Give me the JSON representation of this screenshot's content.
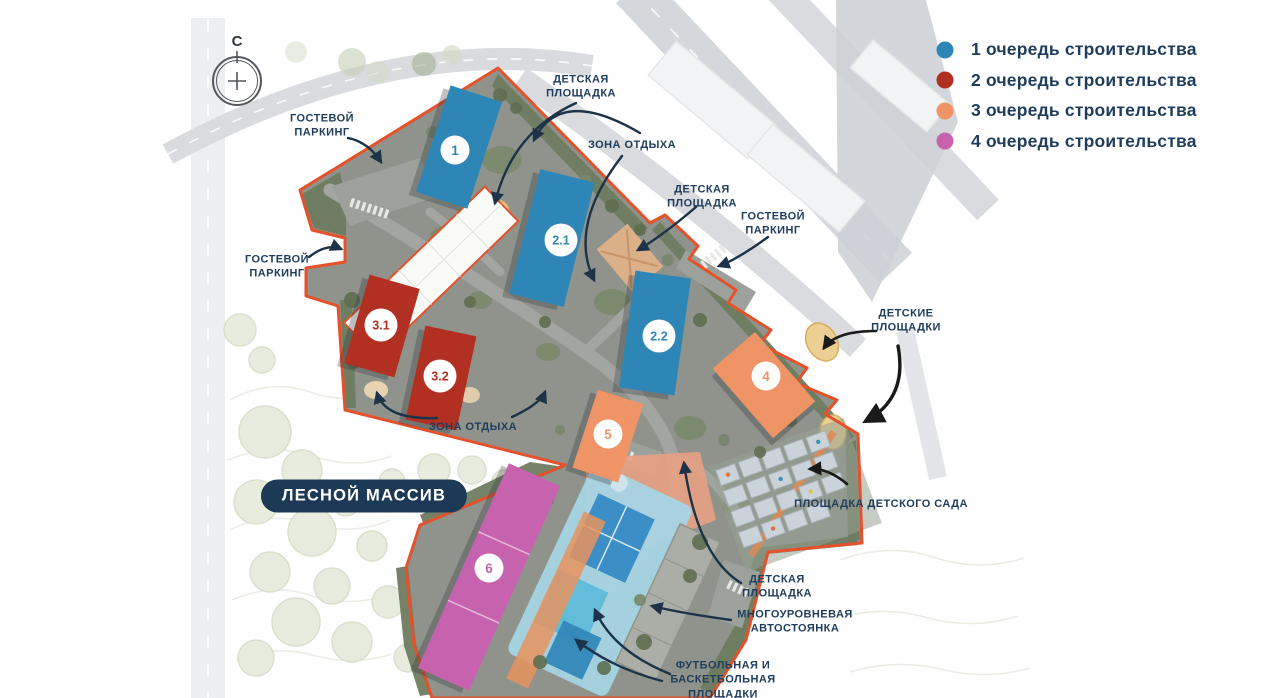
{
  "compass": {
    "north_letter": "С"
  },
  "legend": {
    "items": [
      {
        "label": "1 очередь строительства",
        "color": "#2E86B7"
      },
      {
        "label": "2 очередь строительства",
        "color": "#B13022"
      },
      {
        "label": "3 очередь строительства",
        "color": "#EE9466"
      },
      {
        "label": "4 очередь строительства",
        "color": "#C763AE"
      }
    ]
  },
  "forest_badge": {
    "text": "ЛЕСНОЙ МАССИВ"
  },
  "buildings": [
    {
      "number": "1",
      "phase": "1"
    },
    {
      "number": "2.1",
      "phase": "1"
    },
    {
      "number": "2.2",
      "phase": "1"
    },
    {
      "number": "3.1",
      "phase": "2"
    },
    {
      "number": "3.2",
      "phase": "2"
    },
    {
      "number": "4",
      "phase": "3"
    },
    {
      "number": "5",
      "phase": "3"
    },
    {
      "number": "6",
      "phase": "4"
    }
  ],
  "annotations": [
    {
      "id": "guest-parking-top",
      "text": "ГОСТЕВОЙ ПАРКИНГ"
    },
    {
      "id": "playground-top",
      "text": "ДЕТСКАЯ ПЛОЩАДКА"
    },
    {
      "id": "rest-area-top",
      "text": "ЗОНА ОТДЫХА"
    },
    {
      "id": "playground-mid",
      "text": "ДЕТСКАЯ ПЛОЩАДКА"
    },
    {
      "id": "guest-parking-right",
      "text": "ГОСТЕВОЙ ПАРКИНГ"
    },
    {
      "id": "guest-parking-left",
      "text": "ГОСТЕВОЙ ПАРКИНГ"
    },
    {
      "id": "playgrounds-right",
      "text": "ДЕТСКИЕ ПЛОЩАДКИ"
    },
    {
      "id": "rest-area-bottom",
      "text": "ЗОНА ОТДЫХА"
    },
    {
      "id": "kindergarten-area",
      "text": "ПЛОЩАДКА ДЕТСКОГО САДА"
    },
    {
      "id": "playground-bottom",
      "text": "ДЕТСКАЯ ПЛОЩАДКА"
    },
    {
      "id": "multilevel-parking",
      "text": "МНОГОУРОВНЕВАЯ АВТОСТОЯНКА"
    },
    {
      "id": "sports-grounds",
      "text": "ФУТБОЛЬНАЯ И БАСКЕТБОЛЬНАЯ ПЛОЩАДКИ"
    }
  ],
  "colors": {
    "phase1": "#2E86B7",
    "phase2": "#B13022",
    "phase3": "#EE9466",
    "phase4": "#C763AE",
    "boundary": "#E4512B",
    "label_text": "#1E3D5C",
    "badge_background": "#1C3A55",
    "arrow_navy": "#1C3349",
    "arrow_black": "#1A1A1A"
  }
}
